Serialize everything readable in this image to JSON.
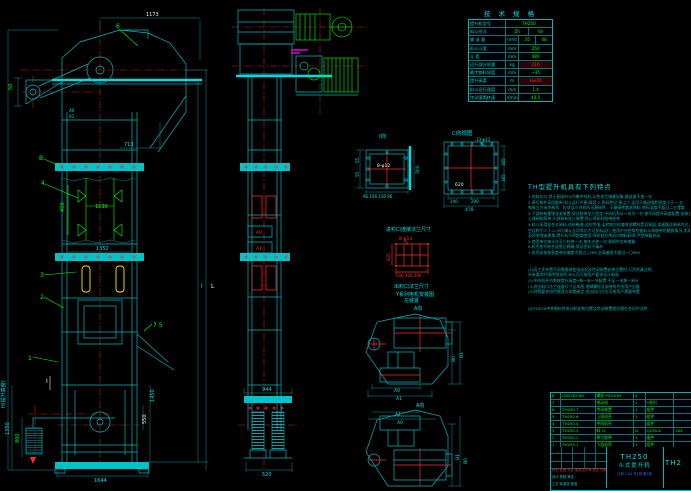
{
  "colors": {
    "background": "#000000",
    "line_cyan": "#00b4bc",
    "centerline_red": "#ff2a2a",
    "label_green": "#00ff00",
    "bucket_yellow": "#ffe000",
    "accent_magenta": "#ff00ff",
    "text_cyan": "#00e0e0",
    "text_white": "#f0f0f0",
    "scale_blue": "#3a6cff"
  },
  "spec_table": {
    "title": "技 术 规 格",
    "rows": [
      {
        "label": "提升机型号",
        "unit": "",
        "v1": "TH250"
      },
      {
        "label": "料斗形式",
        "unit": "",
        "v1": "Zh",
        "v2": "Sh"
      },
      {
        "label": "输 送 量",
        "unit": "m³/h",
        "v1": "35",
        "v2": "48"
      },
      {
        "label": "料斗斗宽",
        "unit": "mm",
        "v1": "250"
      },
      {
        "label": "斗  距",
        "unit": "mm",
        "v1": "480"
      },
      {
        "label": "运行部分质量",
        "unit": "kg",
        "v1": "216",
        "red": true
      },
      {
        "label": "最大物料块度",
        "unit": "mm",
        "v1": "~35"
      },
      {
        "label": "提升高度",
        "unit": "m",
        "v1": "H≤30",
        "red": true
      },
      {
        "label": "料斗运行速度",
        "unit": "m/s",
        "v1": "1.4"
      },
      {
        "label": "传动滚筒转速",
        "unit": "r/min",
        "v1": "44.5"
      }
    ]
  },
  "notes": {
    "heading": "TH型提升机具有下列特点",
    "lines": [
      "1.给料均匀,禁止直接向斗内集中给料,以免发生堵塞现象,输送量不变一台",
      "2.牵引构件采用胶带,料斗运行平稳,噪音小,密封性好,扬尘少,适用于输送堆积密度小于一·五",
      "  吨每立方米的粉状、粒状及小块状的无磨琢性、半磨琢性散状物料,物料温度不超过二五零度",
      "3.下部装有重锤张紧装置,保证胶带张力恒定,中间机壳以一米为一节,按不同提升高度配置,安装方便,",
      "  土建结构简单,头部装有逆止装置,防止停机时胶带逆转",
      "4.料斗采用混合式卸料,进料畅通,适应性强,运转前应检查各部螺栓是否紧固,减速器及轴承内注入润滑油脂,",
      "  空运转不少于二小时,确认无异常后方可投料运行,使用中应经常检查料斗和胶带的磨损情况,发现损坏应",
      "  及时修理或更换,提升机不得超载使用,停机前应将机内物料卸净,严禁带载启动",
      "5.使用单位每半年至少检修一次,每年大修一次,易损件应有储备",
      "6.机壳各节结合面垫石棉绳,保证密封不漏灰",
      "7.机壳安装垂直度每米偏差不超过二MM,全高偏差不超过一〇MM",
      "",
      "",
      "(1)因工艺布置不同需要改变电动机及传动装置安装位置时,订货时请注明,",
      "   另有要求时需附图说明,本公司可按用户要求设计制造",
      "(2)中间机壳节数按提升高度H每一米一节配置,不足一米按一米计",
      "(3)进出料口法兰连接尺寸见本图,地脚螺栓及安装附件由用户自备",
      "(4)特殊要求由供需双方协商确定,进出料口方位可按用户需要布置",
      "",
      "",
      "(5)TH250中央装料时电动机安装位置及传动装置旋向需在合同中注明"
    ]
  },
  "bom": {
    "headers": [
      "件号",
      "代  号",
      "名  称",
      "数量",
      "材  料",
      "备 注"
    ],
    "rows": [
      [
        "8",
        "GB5782-86",
        "螺栓 M20×65",
        "4",
        "",
        ""
      ],
      [
        "7",
        "",
        "电动机",
        "1",
        "Y系列",
        ""
      ],
      [
        "6",
        "TH250.7",
        "传动装置",
        "1",
        "组件",
        ""
      ],
      [
        "5",
        "TH250.6",
        "上段机壳",
        "1",
        "组件",
        ""
      ],
      [
        "4",
        "TH250.4",
        "中间机壳",
        "",
        "组件",
        ""
      ],
      [
        "3",
        "TH250.3",
        "料  斗",
        "N",
        "Q235-A",
        "204"
      ],
      [
        "2",
        "TH250.2",
        "牵引胶带",
        "1",
        "备件",
        ""
      ],
      [
        "1",
        "TH250.1",
        "下段机壳",
        "1",
        "组件",
        ""
      ]
    ]
  },
  "title_block": {
    "model": "TH250",
    "product_name": "斗式提升机",
    "drawing_no": "TH2",
    "revision_row": "标记 处数 分区 更改文件号 签名 日期",
    "staff_row1": "设计  校核  审定",
    "staff_row2": "工艺  标准化  批准",
    "scale_strip": "比例 1:25  共1张 第1张"
  },
  "annotations": [
    {
      "t": "1173",
      "x": 146,
      "y": 16,
      "c": "w",
      "s": 5
    },
    {
      "t": "6",
      "x": 116,
      "y": 28,
      "c": "g",
      "s": 6
    },
    {
      "t": "50",
      "x": 12,
      "y": 90,
      "c": "g",
      "s": 5,
      "r": -90
    },
    {
      "t": "A0",
      "x": 69,
      "y": 112,
      "c": "c",
      "s": 4
    },
    {
      "t": "A1",
      "x": 69,
      "y": 118,
      "c": "c",
      "s": 4
    },
    {
      "t": "B",
      "x": 39,
      "y": 160,
      "c": "g",
      "s": 6
    },
    {
      "t": "4",
      "x": 41,
      "y": 185,
      "c": "g",
      "s": 6
    },
    {
      "t": "450",
      "x": 64,
      "y": 212,
      "c": "g",
      "s": 5,
      "r": -90
    },
    {
      "t": "1130",
      "x": 95,
      "y": 208,
      "c": "g",
      "s": 5
    },
    {
      "t": "713",
      "x": 124,
      "y": 146,
      "c": "c",
      "s": 5
    },
    {
      "t": "1352",
      "x": 96,
      "y": 250,
      "c": "c",
      "s": 5
    },
    {
      "t": "3",
      "x": 40,
      "y": 277,
      "c": "g",
      "s": 6
    },
    {
      "t": "2",
      "x": 40,
      "y": 299,
      "c": "g",
      "s": 6
    },
    {
      "t": "7 5",
      "x": 153,
      "y": 327,
      "c": "g",
      "s": 6
    },
    {
      "t": "1",
      "x": 28,
      "y": 360,
      "c": "g",
      "s": 6
    },
    {
      "t": "I",
      "x": 46,
      "y": 383,
      "c": "w",
      "s": 6
    },
    {
      "t": "1350",
      "x": 9,
      "y": 435,
      "c": "c",
      "s": 5,
      "r": -90
    },
    {
      "t": "800",
      "x": 19,
      "y": 443,
      "c": "g",
      "s": 5,
      "r": -90
    },
    {
      "t": "1644",
      "x": 94,
      "y": 482,
      "c": "c",
      "s": 5
    },
    {
      "t": "1450",
      "x": 154,
      "y": 402,
      "c": "c",
      "s": 5,
      "r": -90
    },
    {
      "t": "550",
      "x": 146,
      "y": 424,
      "c": "w",
      "s": 5,
      "r": -90
    },
    {
      "t": "H(提升高度)",
      "x": 5,
      "y": 408,
      "c": "c",
      "s": 5,
      "r": -90
    },
    {
      "t": "l",
      "x": 201,
      "y": 288,
      "c": "c",
      "s": 6
    },
    {
      "t": "L",
      "x": 211,
      "y": 288,
      "c": "w",
      "s": 6
    },
    {
      "t": "944",
      "x": 262,
      "y": 391,
      "c": "c",
      "s": 5
    },
    {
      "t": "520",
      "x": 262,
      "y": 476,
      "c": "c",
      "s": 5
    },
    {
      "t": "A0",
      "x": 256,
      "y": 234,
      "c": "r",
      "s": 4.5
    },
    {
      "t": "A1",
      "x": 256,
      "y": 250,
      "c": "r",
      "s": 4.5
    },
    {
      "t": "I向",
      "x": 379,
      "y": 138,
      "c": "c",
      "s": 5.5
    },
    {
      "t": "8-φ12",
      "x": 377,
      "y": 167,
      "c": "w",
      "s": 4.5
    },
    {
      "t": "300",
      "x": 419,
      "y": 174,
      "c": "c",
      "s": 4.5,
      "r": -90
    },
    {
      "t": "55",
      "x": 359,
      "y": 163,
      "c": "c",
      "s": 4,
      "r": -90
    },
    {
      "t": "55",
      "x": 359,
      "y": 177,
      "c": "c",
      "s": 4,
      "r": -90
    },
    {
      "t": "96 156 156 96",
      "x": 363,
      "y": 198,
      "c": "c",
      "s": 4
    },
    {
      "t": "C向视图",
      "x": 452,
      "y": 135,
      "c": "c",
      "s": 5.5
    },
    {
      "t": "13-φ12",
      "x": 476,
      "y": 141,
      "c": "c",
      "s": 4
    },
    {
      "t": "620",
      "x": 455,
      "y": 186,
      "c": "w",
      "s": 4.5
    },
    {
      "t": "240",
      "x": 450,
      "y": 203,
      "c": "c",
      "s": 4
    },
    {
      "t": "200",
      "x": 471,
      "y": 203,
      "c": "c",
      "s": 4
    },
    {
      "t": "478",
      "x": 465,
      "y": 211,
      "c": "c",
      "s": 4.5
    },
    {
      "t": "165",
      "x": 505,
      "y": 166,
      "c": "c",
      "s": 4,
      "r": -90
    },
    {
      "t": "165",
      "x": 505,
      "y": 182,
      "c": "c",
      "s": 4,
      "r": -90
    },
    {
      "t": "进料口连接法兰尺寸",
      "x": 386,
      "y": 231,
      "c": "c",
      "s": 5
    },
    {
      "t": "8-φ14",
      "x": 399,
      "y": 240,
      "c": "r",
      "s": 4.5
    },
    {
      "t": "425",
      "x": 390,
      "y": 261,
      "c": "r",
      "s": 4,
      "r": -90
    },
    {
      "t": "200 300 200",
      "x": 396,
      "y": 277,
      "c": "r",
      "s": 4
    },
    {
      "t": "出料口法兰尺寸",
      "x": 394,
      "y": 288,
      "c": "c",
      "s": 5
    },
    {
      "t": "Y系列电机安装图",
      "x": 396,
      "y": 296,
      "c": "c",
      "s": 5
    },
    {
      "t": "左装置",
      "x": 404,
      "y": 302,
      "c": "c",
      "s": 5
    },
    {
      "t": "A向",
      "x": 414,
      "y": 310,
      "c": "c",
      "s": 5
    },
    {
      "t": "A0",
      "x": 394,
      "y": 392,
      "c": "c",
      "s": 4.5
    },
    {
      "t": "A1",
      "x": 396,
      "y": 400,
      "c": "c",
      "s": 4.5
    },
    {
      "t": "B0",
      "x": 455,
      "y": 362,
      "c": "c",
      "s": 4.5,
      "r": -90
    },
    {
      "t": "B1",
      "x": 463,
      "y": 358,
      "c": "c",
      "s": 4.5,
      "r": -90
    },
    {
      "t": "A向",
      "x": 416,
      "y": 407,
      "c": "c",
      "s": 5
    },
    {
      "t": "A1",
      "x": 395,
      "y": 416,
      "c": "c",
      "s": 4.5
    },
    {
      "t": "A0",
      "x": 397,
      "y": 424,
      "c": "c",
      "s": 4.5
    },
    {
      "t": "B1",
      "x": 459,
      "y": 460,
      "c": "c",
      "s": 4.5,
      "r": -90
    },
    {
      "t": "B0",
      "x": 467,
      "y": 464,
      "c": "c",
      "s": 4.5,
      "r": -90
    }
  ]
}
